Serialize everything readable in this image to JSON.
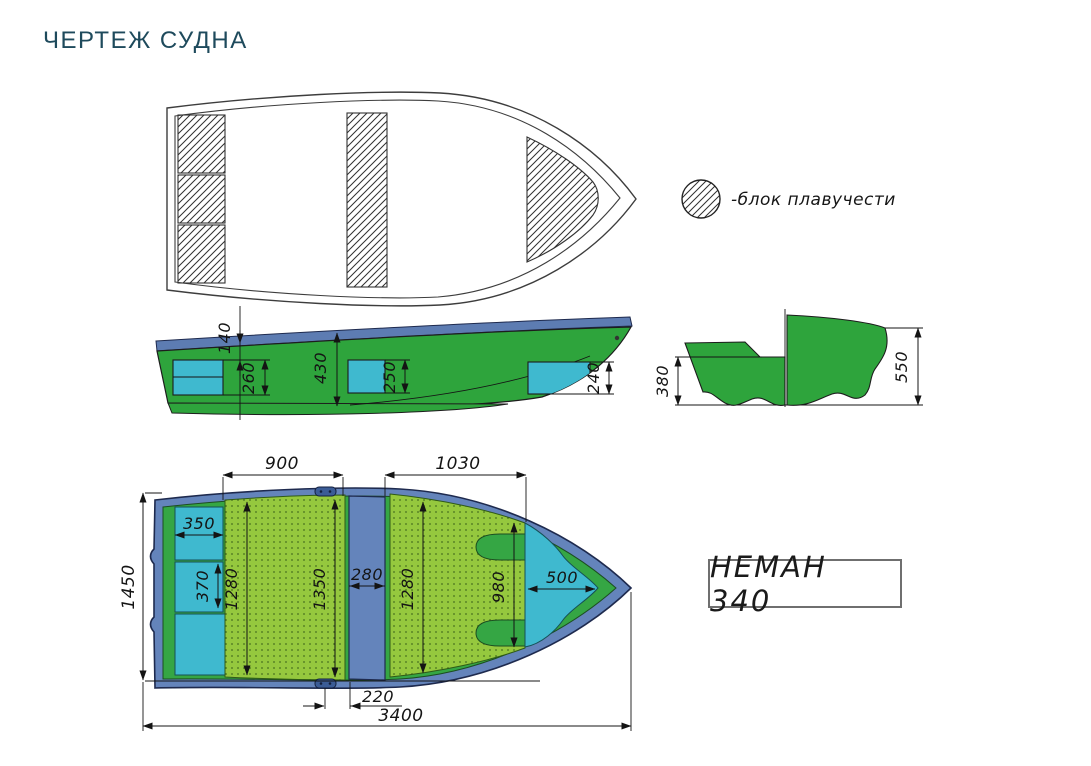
{
  "title": "ЧЕРТЕЖ СУДНА",
  "legend": {
    "label": "-блок плавучести"
  },
  "model": {
    "label": "НЕМАН 340"
  },
  "dims": {
    "side": {
      "d140": "140",
      "d260": "260",
      "d430": "430",
      "d250": "250",
      "d240": "240"
    },
    "section": {
      "d380": "380",
      "d550": "550"
    },
    "plan": {
      "d900": "900",
      "d1030": "1030",
      "d350": "350",
      "d370": "370",
      "d1280L": "1280",
      "d1350": "1350",
      "d280": "280",
      "d1280R": "1280",
      "d980": "980",
      "d500": "500",
      "d220": "220",
      "d1450": "1450",
      "d3400": "3400"
    }
  },
  "colors": {
    "hull_green": "#2ea43c",
    "gunwale_blue": "#5d7cb2",
    "deck_blue": "#6484bb",
    "floor_green": "#95c83e",
    "foam_cyan": "#3fb9cf",
    "accent_green": "#35a644",
    "title_text": "#1e4a5c"
  }
}
